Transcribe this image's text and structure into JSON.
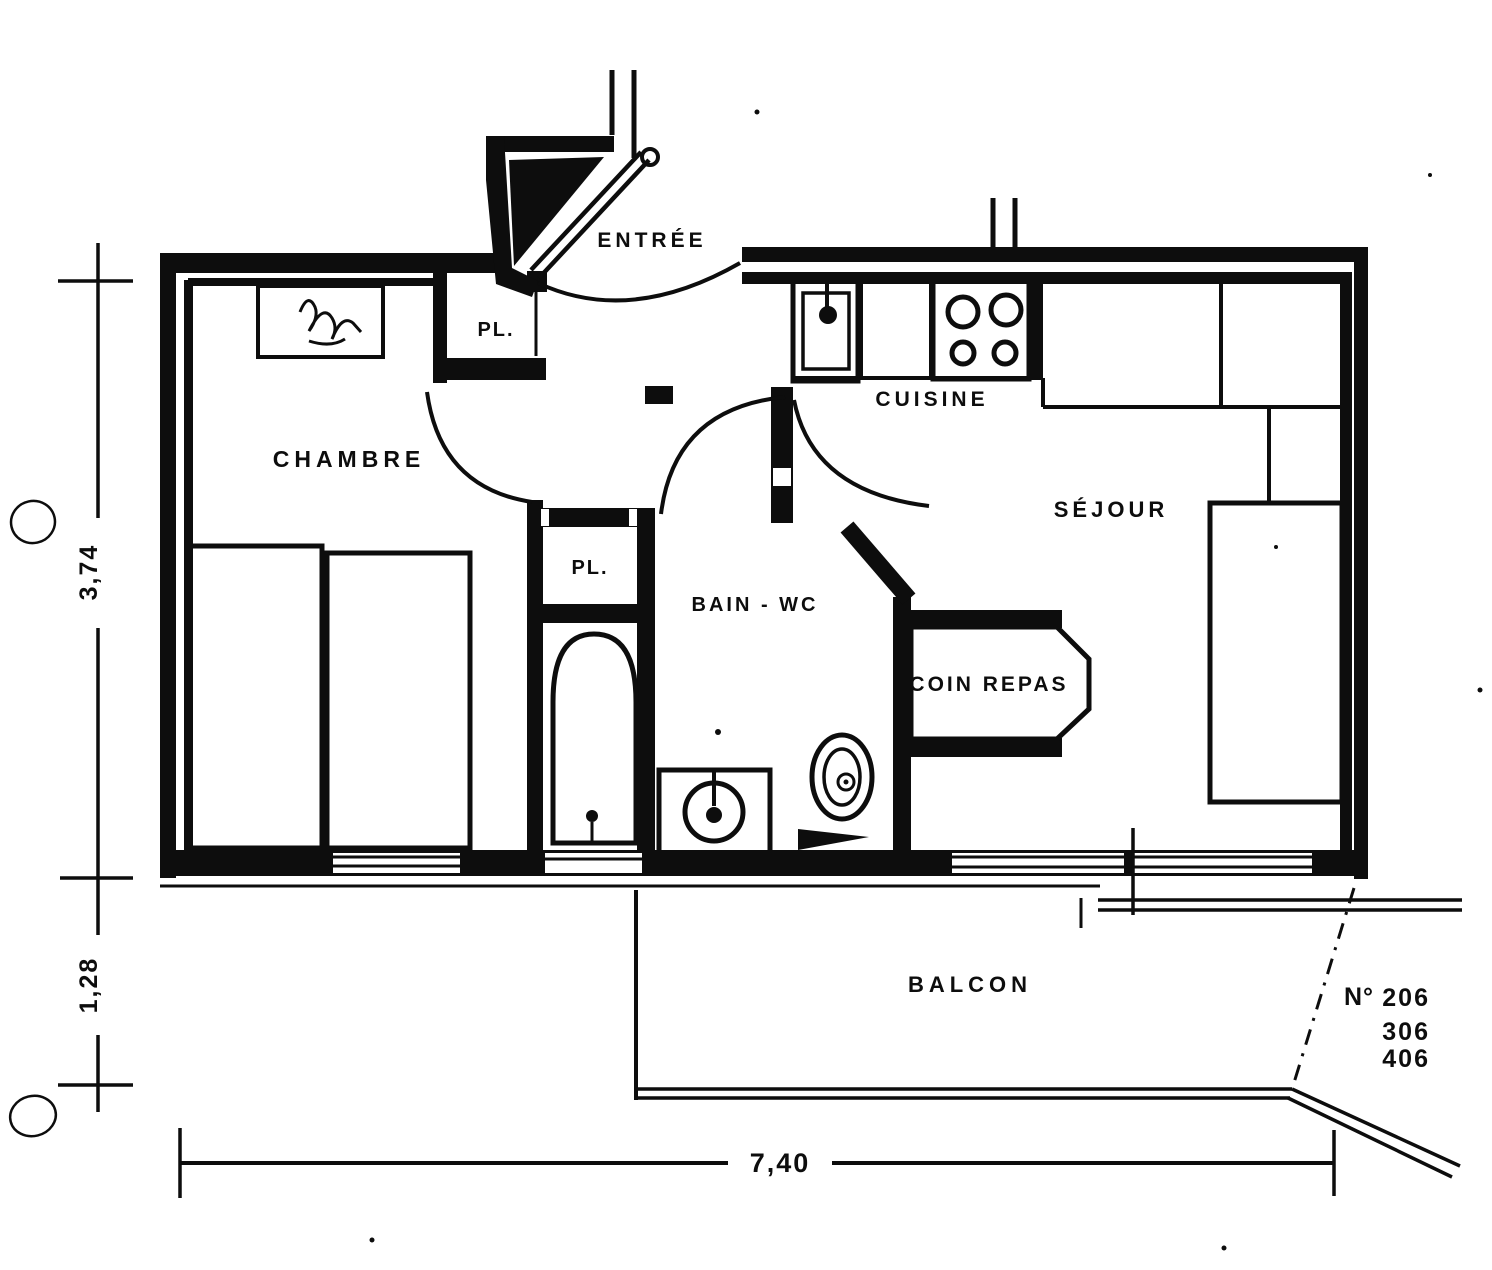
{
  "document": {
    "type": "apartment floor plan (scanned blueprint)",
    "colors": {
      "ink": "#0d0d0d",
      "paper": "#ffffff"
    }
  },
  "rooms": {
    "entree": {
      "label": "ENTRÉE"
    },
    "chambre": {
      "label": "CHAMBRE"
    },
    "closet1": {
      "label": "PL."
    },
    "closet2": {
      "label": "PL."
    },
    "cuisine": {
      "label": "CUISINE"
    },
    "sejour": {
      "label": "SÉJOUR"
    },
    "bain_wc": {
      "label": "BAIN - WC"
    },
    "coin_repas": {
      "label": "COIN REPAS"
    },
    "balcon": {
      "label": "BALCON"
    }
  },
  "dimensions": {
    "left_upper": "3,74",
    "left_lower": "1,28",
    "bottom": "7,40"
  },
  "units": {
    "prefix": "N°",
    "numbers": [
      "206",
      "306",
      "406"
    ]
  }
}
